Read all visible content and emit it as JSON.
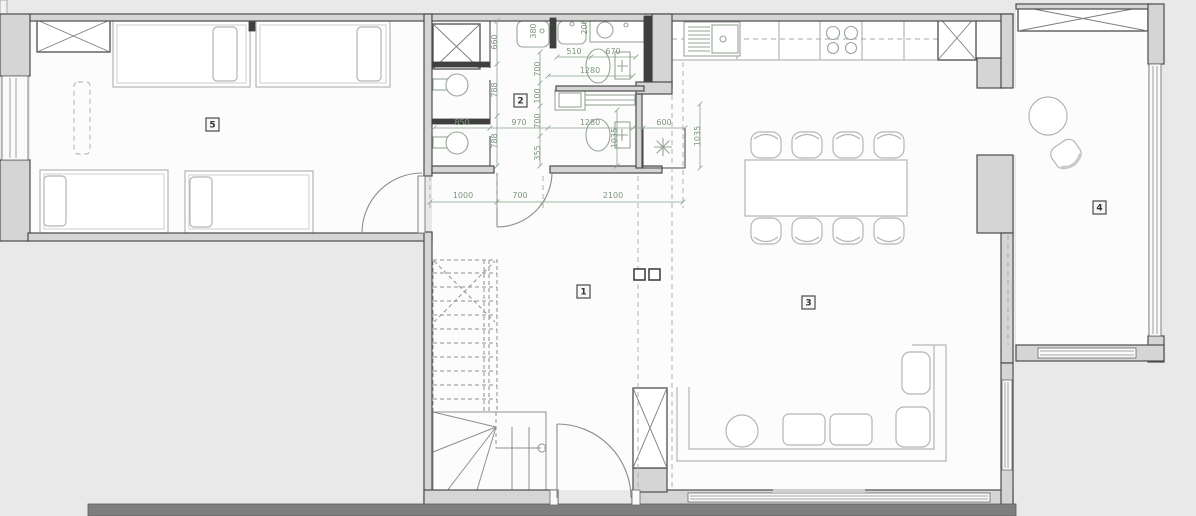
{
  "title": "apartment-floor-plan",
  "rooms": {
    "r1": "1",
    "r2": "2",
    "r3": "3",
    "r4": "4",
    "r5": "5"
  },
  "dims": {
    "v660": "660",
    "v788a": "788",
    "v788b": "788",
    "v380": "380",
    "v200": "200",
    "v700a": "700",
    "v100": "100",
    "v700b": "700",
    "v355": "355",
    "h510": "510",
    "h670": "670",
    "h1280a": "1280",
    "h850": "850",
    "h970": "970",
    "h1280b": "1280",
    "h600": "600",
    "v1035a": "1035",
    "v1035b": "1035",
    "h1000": "1000",
    "h700c": "700",
    "h2100": "2100"
  },
  "symbols": {
    "shaft_marker": "x-cross",
    "drain_marker": "asterisk-star",
    "fixtures": [
      "wardrobe",
      "bed",
      "wc",
      "washbasin",
      "counter-sink",
      "toilet",
      "washing-machine",
      "kitchen-sink",
      "hob",
      "vent-shaft",
      "dining-table",
      "chair",
      "sofa",
      "coffee-table",
      "round-table",
      "armchair",
      "stairs",
      "entrance-door",
      "radiator",
      "window"
    ]
  },
  "colors": {
    "background": "#e9e9e9",
    "floor": "#fcfcfc",
    "wall_fill": "#d5d5d5",
    "wall_line": "#4d4d4d",
    "dimension": "#7d967d",
    "furniture": "#b5b5b5",
    "fixture": "#97a597"
  }
}
